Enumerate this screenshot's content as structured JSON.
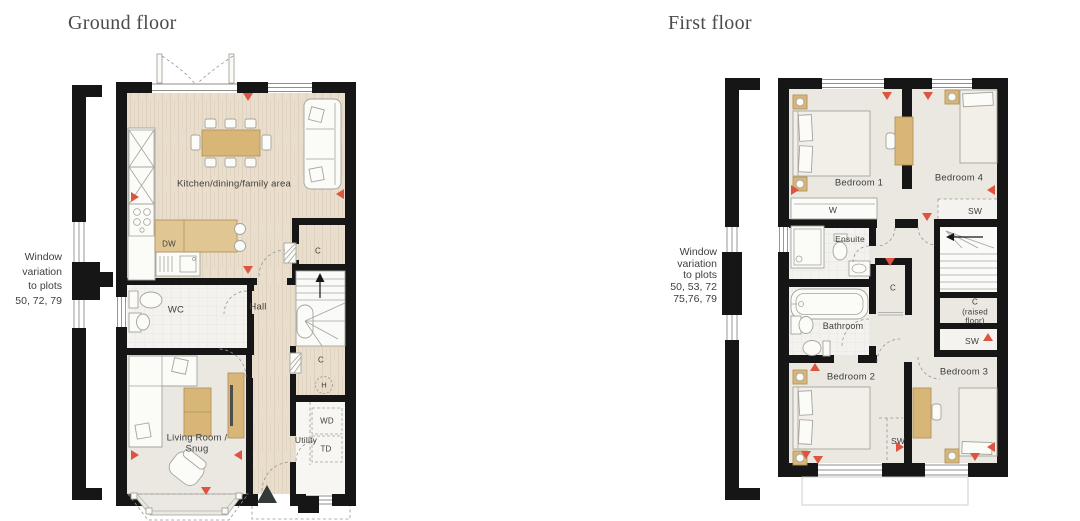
{
  "meta": {
    "width": 1080,
    "height": 521
  },
  "colors": {
    "wall": "#161616",
    "wood_floor": "#e9decd",
    "room_floor": "#eae8e1",
    "tile_floor": "#f3f2ee",
    "stairs_floor": "#fafaf8",
    "furniture_wood": "#d8b678",
    "window_marker_red": "#dd5440",
    "entrance_marker": "#333b38",
    "title_text": "#4c4b48",
    "label_text": "#3e3e3b"
  },
  "ground_floor": {
    "title": "Ground floor",
    "note_lines": [
      "Window",
      "variation",
      "to plots",
      "50, 72, 79"
    ],
    "labels": {
      "kitchen": "Kitchen/dining/family area",
      "dw": "DW",
      "wc": "WC",
      "hall": "Hall",
      "cupboard_upper": "C",
      "cupboard_lower": "C",
      "heater": "H",
      "living_room": "Living Room / Snug",
      "utility": "Utility",
      "wd": "WD",
      "td": "TD"
    }
  },
  "first_floor": {
    "title": "First floor",
    "note_lines": [
      "Window",
      "variation",
      "to plots",
      "50, 53, 72",
      "75,76, 79"
    ],
    "labels": {
      "bedroom1": "Bedroom 1",
      "bedroom4": "Bedroom 4",
      "wardrobe": "W",
      "sw_bedroom4": "SW",
      "ensuite": "Ensuite",
      "cupboard_mid": "C",
      "bathroom": "Bathroom",
      "cupboard_raised": "C (raised floor)",
      "sw_right": "SW",
      "bedroom2": "Bedroom 2",
      "bedroom3": "Bedroom 3",
      "sw_mid": "SW"
    }
  }
}
